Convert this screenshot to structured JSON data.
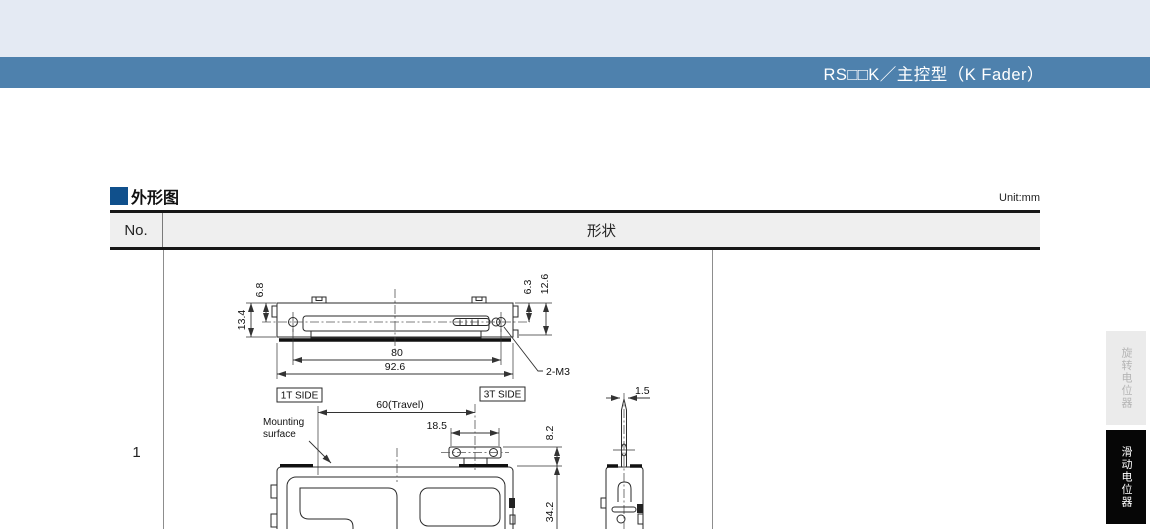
{
  "header": {
    "title": "RS□□K／主控型（K Fader）"
  },
  "section": {
    "title": "外形图",
    "unit": "Unit:mm"
  },
  "table": {
    "col_no": "No.",
    "col_shape": "形状",
    "row_no": "1"
  },
  "drawing": {
    "dim_6_8": "6.8",
    "dim_13_4": "13.4",
    "dim_6_3": "6.3",
    "dim_12_6": "12.6",
    "dim_80": "80",
    "dim_92_6": "92.6",
    "thread_note": "2-M3",
    "label_1t": "1T SIDE",
    "label_3t": "3T SIDE",
    "travel": "60(Travel)",
    "mounting_1": "Mounting",
    "mounting_2": "surface",
    "dim_18_5": "18.5",
    "dim_8_2": "8.2",
    "dim_34_2": "34.2",
    "dim_1_5": "1.5"
  },
  "side_tabs": {
    "rotary": "旋转电位器",
    "slide": "滑动电位器"
  },
  "colors": {
    "accent_blue": "#4e81ad",
    "marker_navy": "#10508c",
    "top_band": "#e4eaf3",
    "tab_active_bg": "#060606",
    "tab_inactive_bg": "#ebebeb"
  }
}
